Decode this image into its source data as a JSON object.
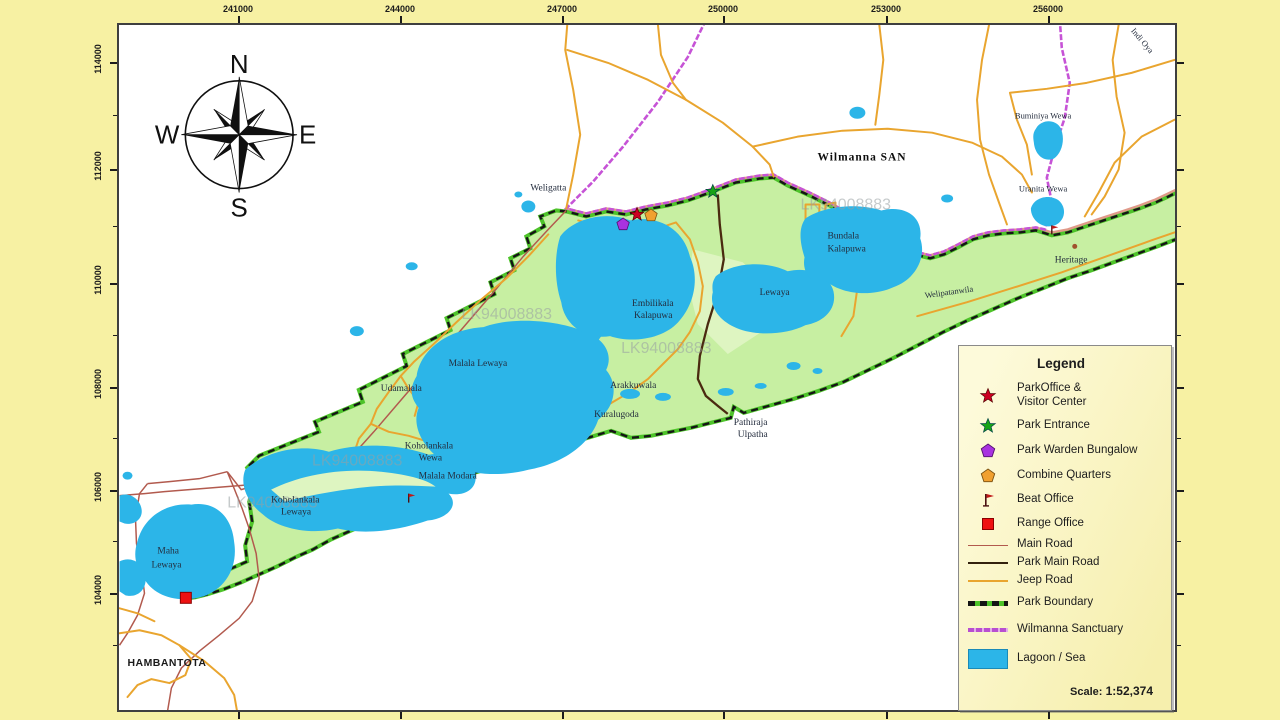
{
  "colors": {
    "margin_yellow": "#f7f1a3",
    "park_green": "#c7efa2",
    "park_green_light": "#def5c1",
    "lagoon_blue": "#2cb5e8",
    "boundary_green": "#4ec32a",
    "boundary_black": "#151515",
    "main_road": "#b25a4e",
    "park_main_road": "#4a2a10",
    "jeep_road": "#e9a52f",
    "sanctuary": "#c653d6",
    "corridor_salmon": "#e09a8a",
    "label_ink": "#232c3d"
  },
  "frame": {
    "top_coords": [
      "241000",
      "244000",
      "247000",
      "250000",
      "253000",
      "256000"
    ],
    "left_coords": [
      "114000",
      "112000",
      "110000",
      "108000",
      "106000",
      "104000"
    ]
  },
  "compass": {
    "n": "N",
    "e": "E",
    "s": "S",
    "w": "W"
  },
  "watermark": {
    "text": "LK94008883"
  },
  "map_labels": {
    "weligatta": "Weligatta",
    "wilmanna_san": "Wilmanna  SAN",
    "indi_oya": "Indi Oya",
    "buminiya_wewa": "Buminiya Wewa",
    "uranita_wewa": "Uranita Wewa",
    "bundala_kalapuwa_1": "Bundala",
    "bundala_kalapuwa_2": "Kalapuwa",
    "lewaya": "Lewaya",
    "embilikala_1": "Embilikala",
    "embilikala_2": "Kalapuwa",
    "malala_lewaya": "Malala Lewaya",
    "udamalala": "Udamalala",
    "arakkuwala": "Arakkuwala",
    "kuralugoda": "Kuralugoda",
    "pathiraja_1": "Pathiraja",
    "pathiraja_2": "Ulpatha",
    "koholankala_wewa_1": "Koholankala",
    "koholankala_wewa_2": "Wewa",
    "malala_modara": "Malala Modara",
    "koholankala_lewaya_1": "Koholankala",
    "koholankala_lewaya_2": "Lewaya",
    "maha_lewaya_1": "Maha",
    "maha_lewaya_2": "Lewaya",
    "hambantota": "HAMBANTOTA",
    "heritage": "Heritage",
    "welipatanwila": "Welipatanwila"
  },
  "legend": {
    "title": "Legend",
    "items": [
      {
        "label": "ParkOffice &",
        "label2": "Visitor Center"
      },
      {
        "label": "Park Entrance"
      },
      {
        "label": "Park Warden Bungalow"
      },
      {
        "label": "Combine Quarters"
      },
      {
        "label": "Beat Office"
      },
      {
        "label": "Range Office"
      },
      {
        "label": "Main Road"
      },
      {
        "label": "Park Main Road"
      },
      {
        "label": "Jeep Road"
      },
      {
        "label": "Park Boundary"
      },
      {
        "label": "Wilmanna Sanctuary"
      },
      {
        "label": "Lagoon / Sea"
      }
    ],
    "scale_label": "Scale:",
    "scale_value": "1:52,374"
  }
}
